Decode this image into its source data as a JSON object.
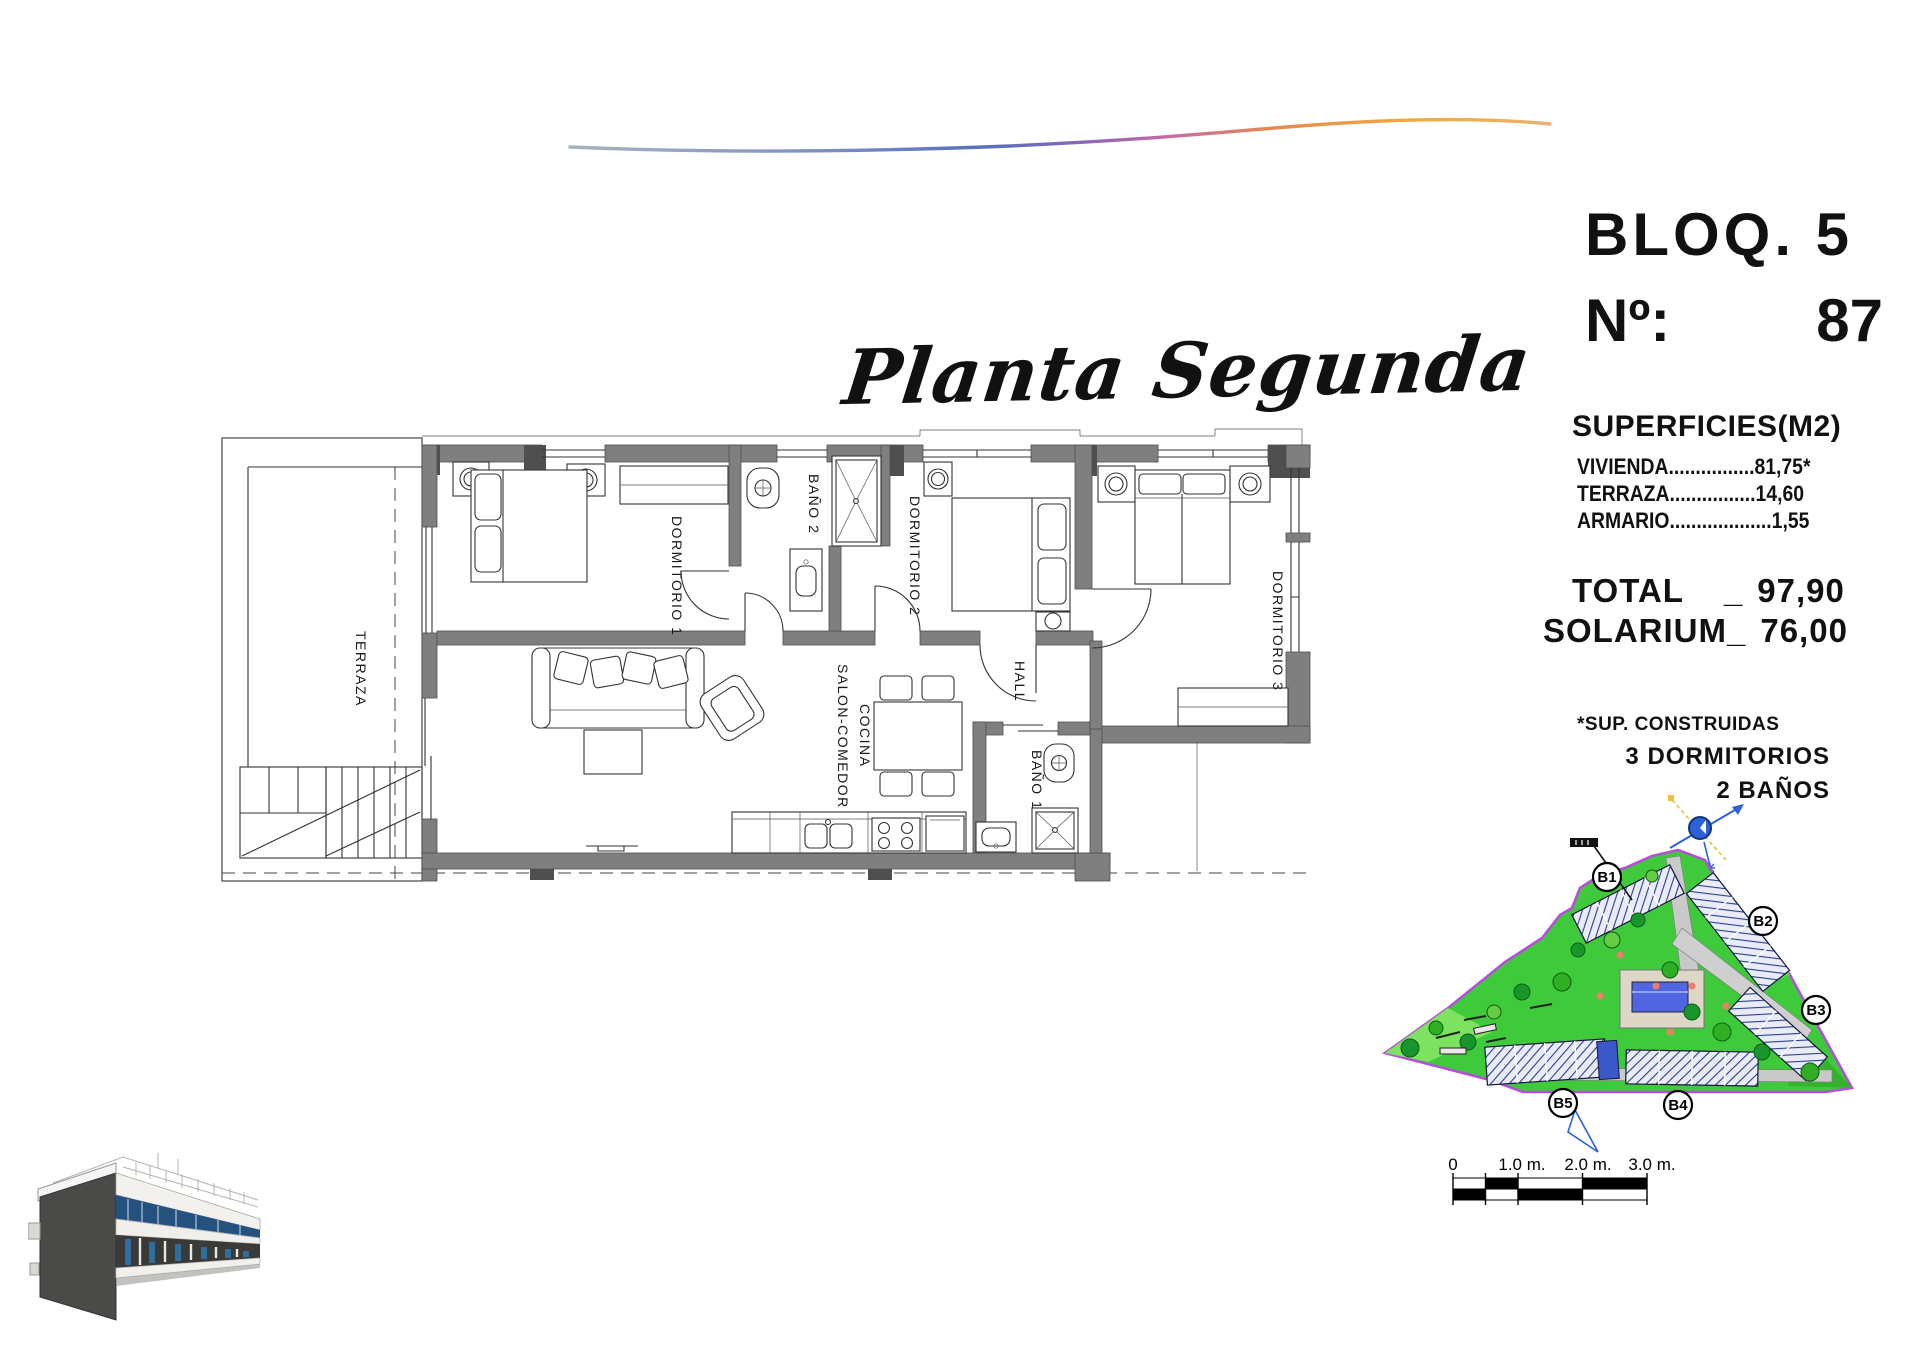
{
  "title": {
    "text": "Planta Segunda"
  },
  "info_panel": {
    "block": "BLOQ. 5",
    "number_label": "Nº:",
    "number_value": "87",
    "superficies_title": "SUPERFICIES(M2)",
    "rows": [
      "VIVIENDA................81,75*",
      "TERRAZA................14,60",
      "ARMARIO...................1,55"
    ],
    "total_label": "TOTAL",
    "total_underscore": "_",
    "total_value": "97,90",
    "solarium_label": "SOLARIUM_",
    "solarium_value": "76,00",
    "footnote": "*SUP. CONSTRUIDAS",
    "bedrooms": "3 DORMITORIOS",
    "bathrooms": "2 BAÑOS"
  },
  "floor_plan": {
    "rooms": {
      "terraza": "TERRAZA",
      "dormitorio1": "DORMITORIO 1",
      "bano2": "BAÑO 2",
      "dormitorio2": "DORMITORIO 2",
      "dormitorio3": "DORMITORIO 3",
      "hall": "HALL",
      "bano1": "BAÑO 1",
      "salon_line1": "SALON-COMEDOR",
      "salon_line2": "COCINA"
    }
  },
  "site_plan": {
    "blocks": [
      {
        "label": "B1"
      },
      {
        "label": "B2"
      },
      {
        "label": "B3"
      },
      {
        "label": "B4"
      },
      {
        "label": "B5"
      }
    ]
  },
  "scale_bar": {
    "labels": [
      "0",
      "1.0 m.",
      "2.0 m.",
      "3.0 m."
    ]
  },
  "colors": {
    "wall_gray": "#7f7f7f",
    "site_green": "#3fca3b",
    "boundary_purple": "#b44fd8",
    "pool_blue": "#4f66e0",
    "accent_navy": "#1c4a86",
    "swoosh_blue": "#4d66b8",
    "swoosh_orange": "#f0a43c"
  }
}
